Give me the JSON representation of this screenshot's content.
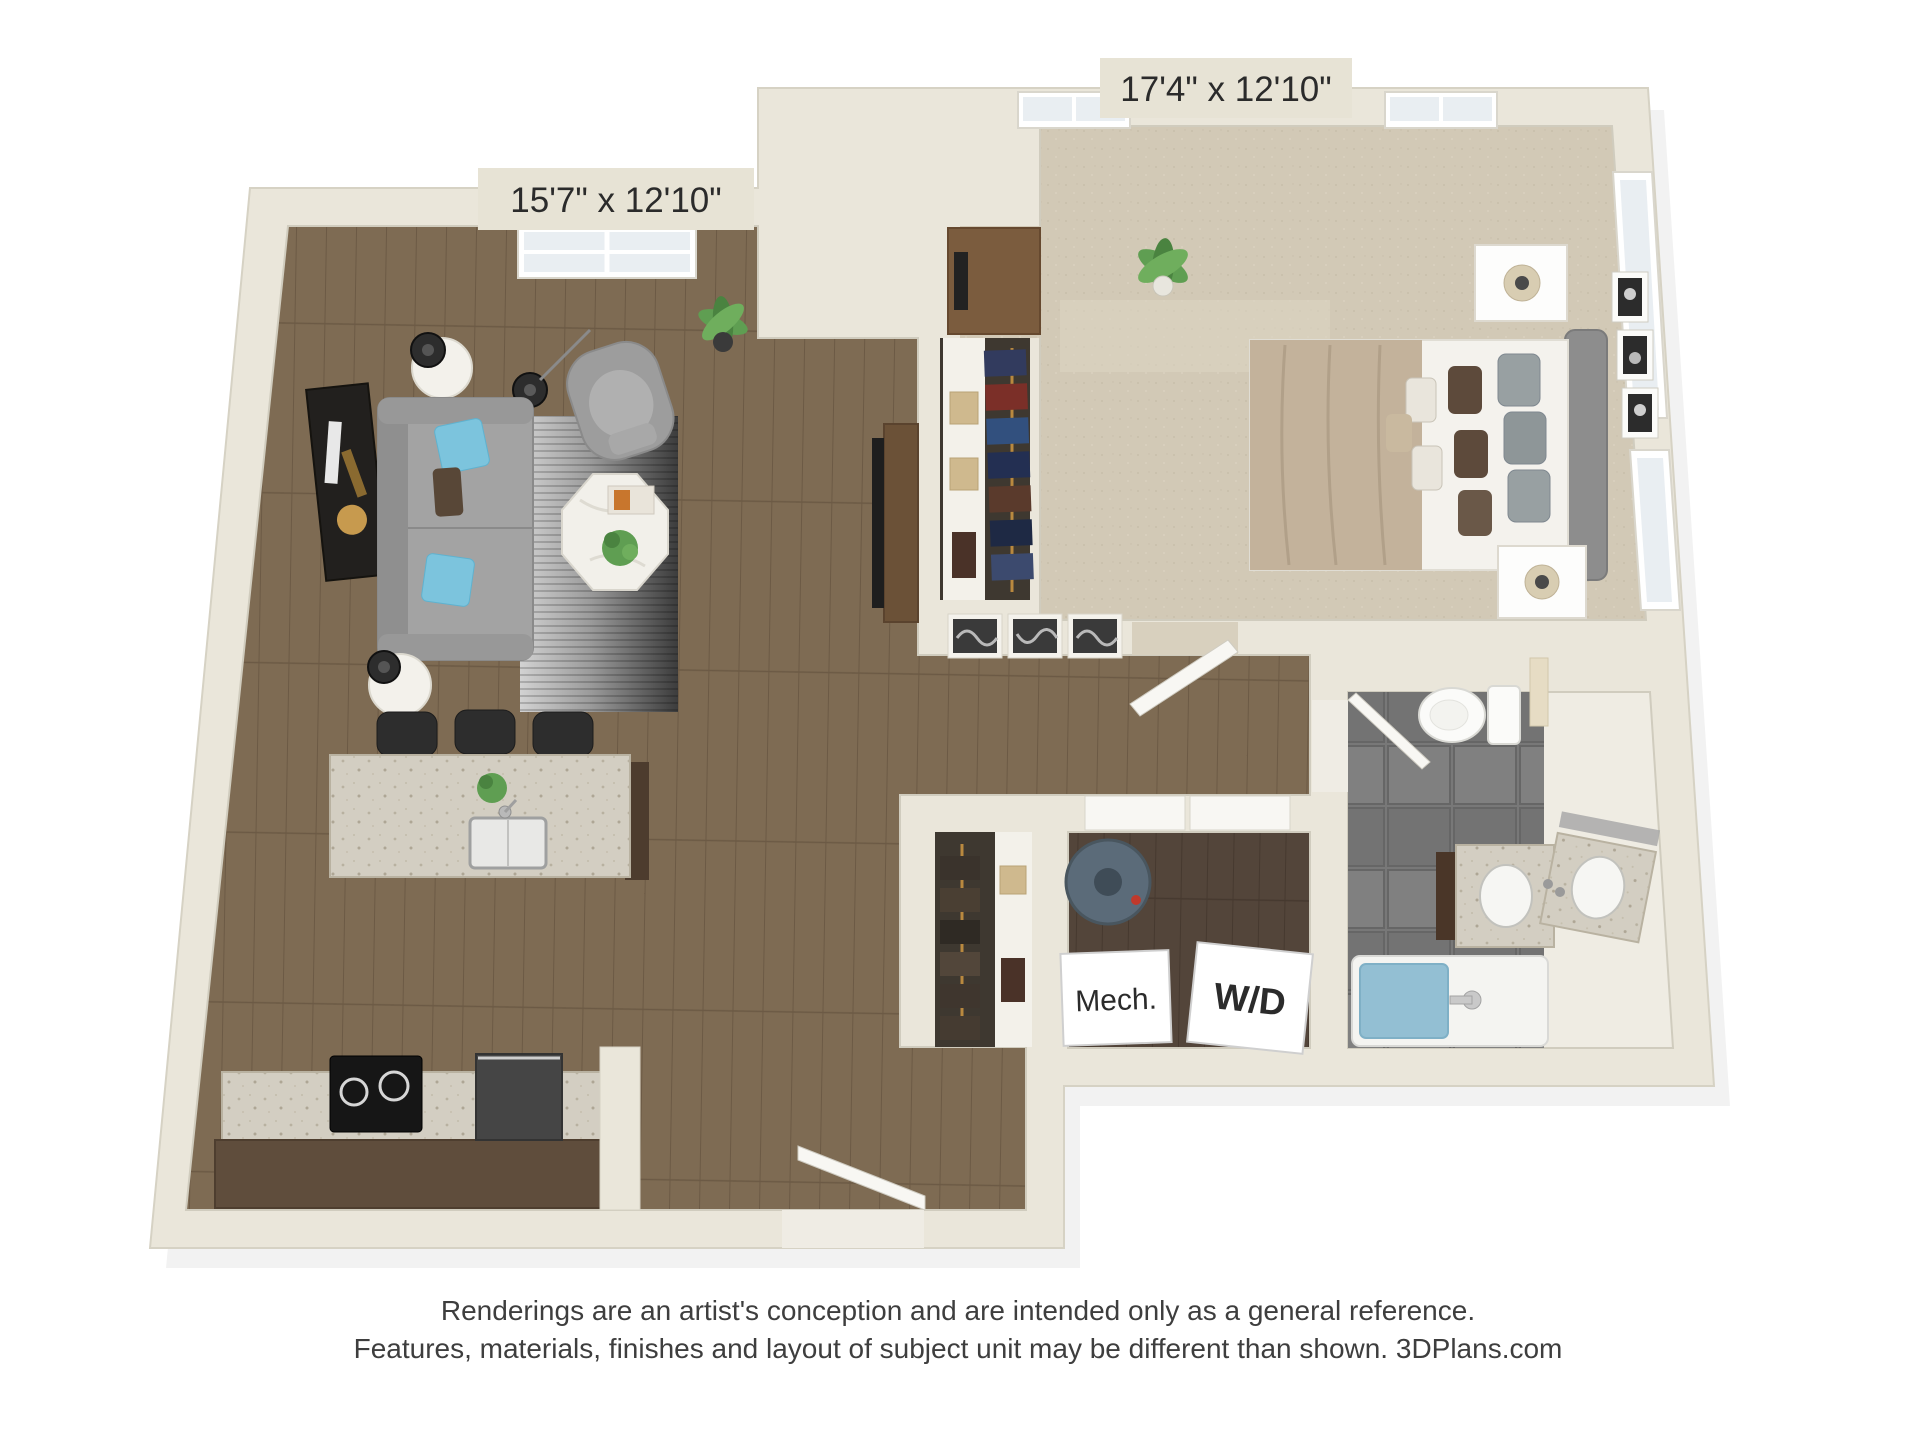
{
  "image": {
    "type": "3d-floor-plan-rendering",
    "view": "top-down",
    "background": "#ffffff"
  },
  "plan": {
    "labels": {
      "living_dim": "15'7\" x 12'10\"",
      "bedroom_dim": "17'4\" x 12'10\"",
      "mech": "Mech.",
      "washer_dryer": "W/D"
    },
    "rooms": [
      {
        "id": "living-dining",
        "dimensions": "15'7\" x 12'10\"",
        "flooring": "hardwood"
      },
      {
        "id": "bedroom",
        "dimensions": "17'4\" x 12'10\"",
        "flooring": "carpet"
      },
      {
        "id": "kitchen",
        "flooring": "hardwood"
      },
      {
        "id": "bathroom",
        "flooring": "gray tile"
      },
      {
        "id": "mechanical-closet",
        "label": "Mech."
      },
      {
        "id": "laundry-closet",
        "label": "W/D"
      },
      {
        "id": "bedroom-closet"
      },
      {
        "id": "hall-closet"
      },
      {
        "id": "entry"
      }
    ],
    "furniture": [
      "sofa",
      "armchair",
      "octagon-coffee-table",
      "area-rug",
      "round-side-tables-with-lamps",
      "wall-art",
      "tv-console",
      "potted-plants",
      "kitchen-island-with-sink",
      "bar-stools",
      "range",
      "refrigerator",
      "bed",
      "nightstands-with-lamps",
      "desk-with-monitor",
      "toilet",
      "double-sink-vanity",
      "bathtub",
      "towel-rack",
      "water-heater",
      "hanging-clothes"
    ],
    "colors": {
      "wall": "#eae6da",
      "wall_edge": "#d6d2c4",
      "wood_floor": "#7e6b53",
      "wood_floor_dark": "#53453a",
      "carpet": "#d2c9b6",
      "tile": "#787878",
      "granite": "#d3cec2",
      "cabinet_brown": "#5f4d3c",
      "sofa_gray": "#a3a3a3",
      "accent_pillow_blue": "#7cc4dd",
      "duvet_tan": "#c3b29b",
      "tub_water_blue": "#93bfd3",
      "label_tag": "#e7e3d5",
      "text": "#2b2b2b"
    }
  },
  "footer": {
    "line1": "Renderings are an artist's conception and are intended only as a general reference.",
    "line2": "Features, materials, finishes and layout of subject unit may be different than shown. 3DPlans.com"
  }
}
